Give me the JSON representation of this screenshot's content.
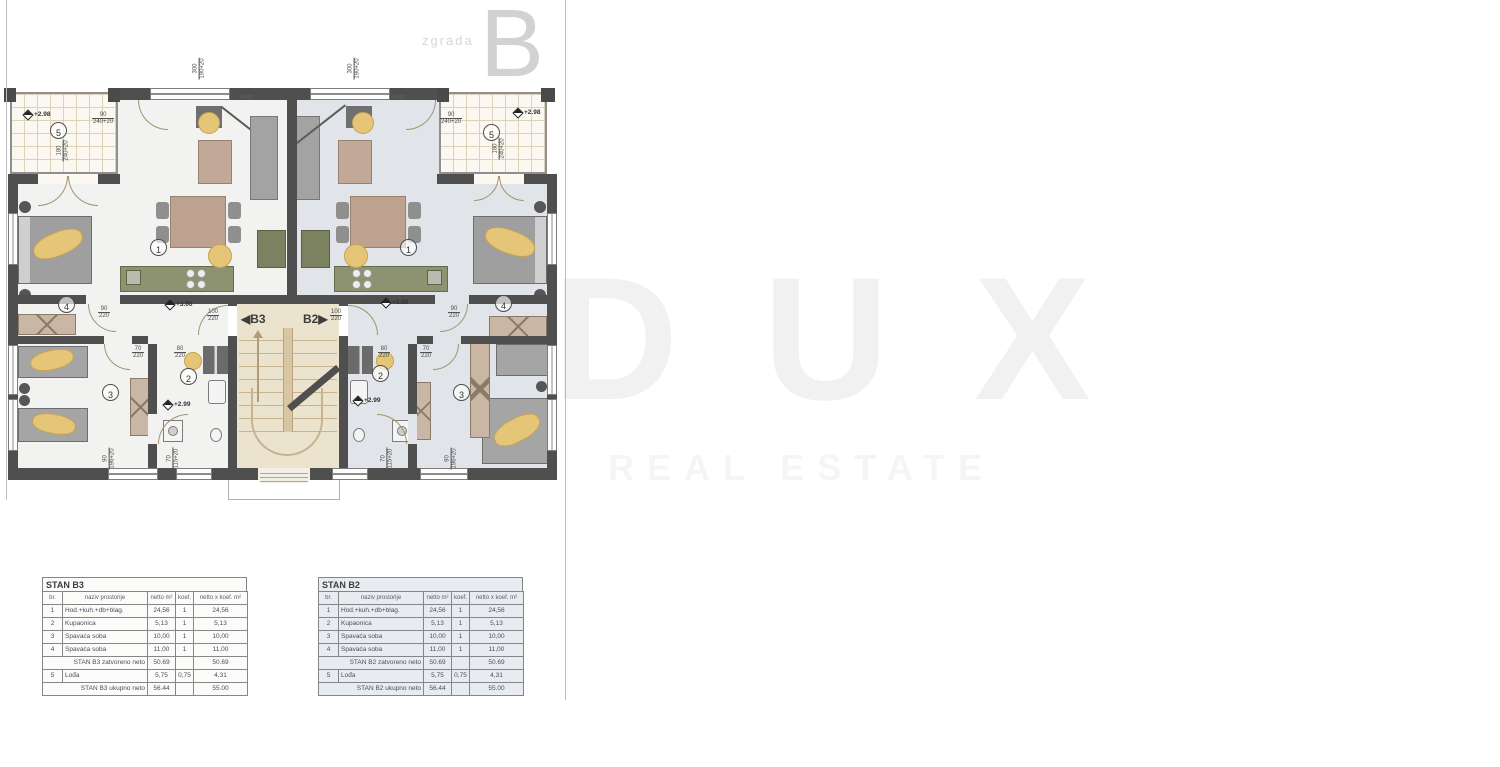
{
  "header": {
    "building_word": "zgrada",
    "building_letter": "B"
  },
  "watermark": {
    "brand": "D U X",
    "tagline": "REAL ESTATE"
  },
  "plan": {
    "unit_doors": {
      "left_arrow": "◀",
      "left_label": "B3",
      "right_label": "B2",
      "right_arrow": "▶"
    },
    "levels": {
      "loggia": "+2.98",
      "hall": "+3.00",
      "bath": "+2.99"
    },
    "rooms": {
      "living": "1",
      "bath": "2",
      "bed_small": "3",
      "bed_large": "4",
      "loggia": "5"
    },
    "dims": {
      "top_window": {
        "v": "300",
        "t": "190+20"
      },
      "loggia_width": {
        "v": "90",
        "t": "240+20"
      },
      "loggia_height": {
        "v": "180",
        "t": "240+20"
      },
      "bedroom_door": {
        "v": "90",
        "t": "220"
      },
      "entry_door": {
        "v": "100",
        "t": "220"
      },
      "bath_door_80": {
        "v": "80",
        "t": "220"
      },
      "bath_door_70": {
        "v": "70",
        "t": "220"
      },
      "window_bedroom": {
        "v": "90",
        "t": "196+20"
      },
      "window_bath": {
        "v": "70",
        "t": "115+20"
      },
      "parapet_note": "P=20"
    }
  },
  "tables": {
    "b3": {
      "title": "STAN B3",
      "headers": [
        "br.",
        "naziv prostorije",
        "netto m²",
        "koef.",
        "netto x koef. m²"
      ],
      "rows": [
        [
          "1",
          "Hod.+kuh.+db+blag.",
          "24,56",
          "1",
          "24,56"
        ],
        [
          "2",
          "Kupaonica",
          "5,13",
          "1",
          "5,13"
        ],
        [
          "3",
          "Spavaća soba",
          "10,00",
          "1",
          "10,00"
        ],
        [
          "4",
          "Spavaća soba",
          "11,00",
          "1",
          "11,00"
        ]
      ],
      "subtotal": [
        "STAN B3 zatvoreno neto",
        "50.69",
        "",
        "50.69"
      ],
      "loggia_row": [
        "5",
        "Lođa",
        "5,75",
        "0,75",
        "4,31"
      ],
      "total": [
        "STAN B3 ukupno neto",
        "56.44",
        "",
        "55.00"
      ]
    },
    "b2": {
      "title": "STAN B2",
      "headers": [
        "br.",
        "naziv prostorije",
        "netto m²",
        "koef.",
        "netto x koef. m²"
      ],
      "rows": [
        [
          "1",
          "Hod.+kuh.+db+blag.",
          "24,56",
          "1",
          "24,56"
        ],
        [
          "2",
          "Kupaonica",
          "5,13",
          "1",
          "5,13"
        ],
        [
          "3",
          "Spavaća soba",
          "10,00",
          "1",
          "10,00"
        ],
        [
          "4",
          "Spavaća soba",
          "11,00",
          "1",
          "11,00"
        ]
      ],
      "subtotal": [
        "STAN B2 zatvoreno neto",
        "50.69",
        "",
        "50.69"
      ],
      "loggia_row": [
        "5",
        "Lođa",
        "5,75",
        "0,75",
        "4,31"
      ],
      "total": [
        "STAN B2 ukupno neto",
        "56.44",
        "",
        "55.00"
      ]
    }
  }
}
